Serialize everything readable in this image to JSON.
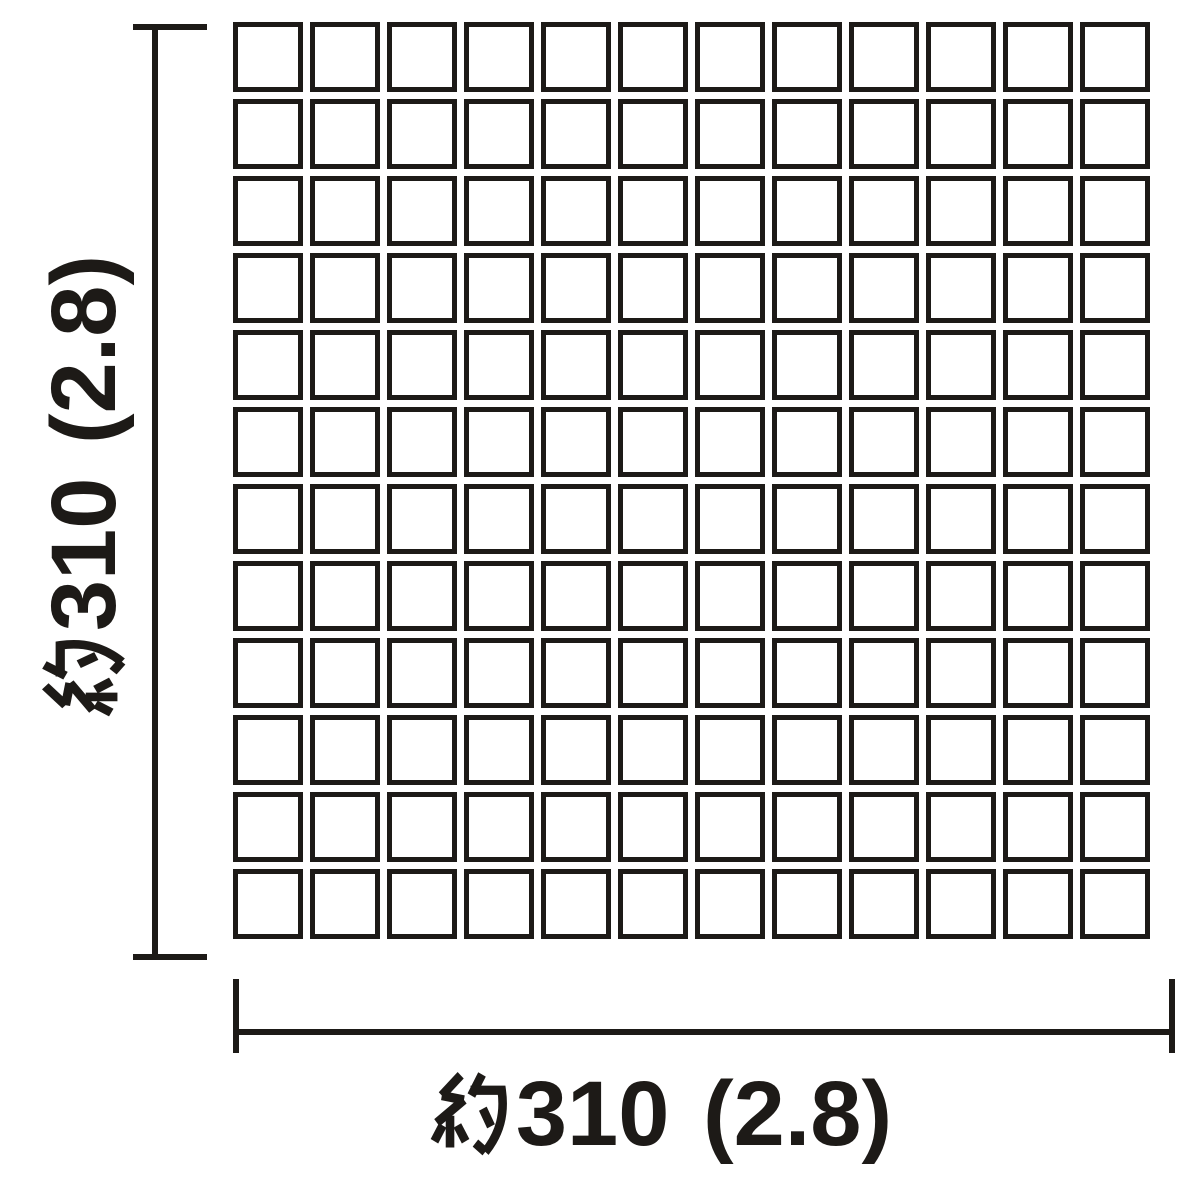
{
  "diagram": {
    "title": "mosaic tile sheet dimension drawing",
    "grid": {
      "rows": 12,
      "cols": 12
    },
    "dimensions": {
      "horizontal": {
        "kanji": "約",
        "value": "310 (2.8)",
        "label": "約310 (2.8)"
      },
      "vertical": {
        "kanji": "約",
        "value": "310 (2.8)",
        "label": "約310 (2.8)"
      }
    },
    "colors": {
      "ink": "#1d1a17",
      "background": "#ffffff"
    }
  }
}
